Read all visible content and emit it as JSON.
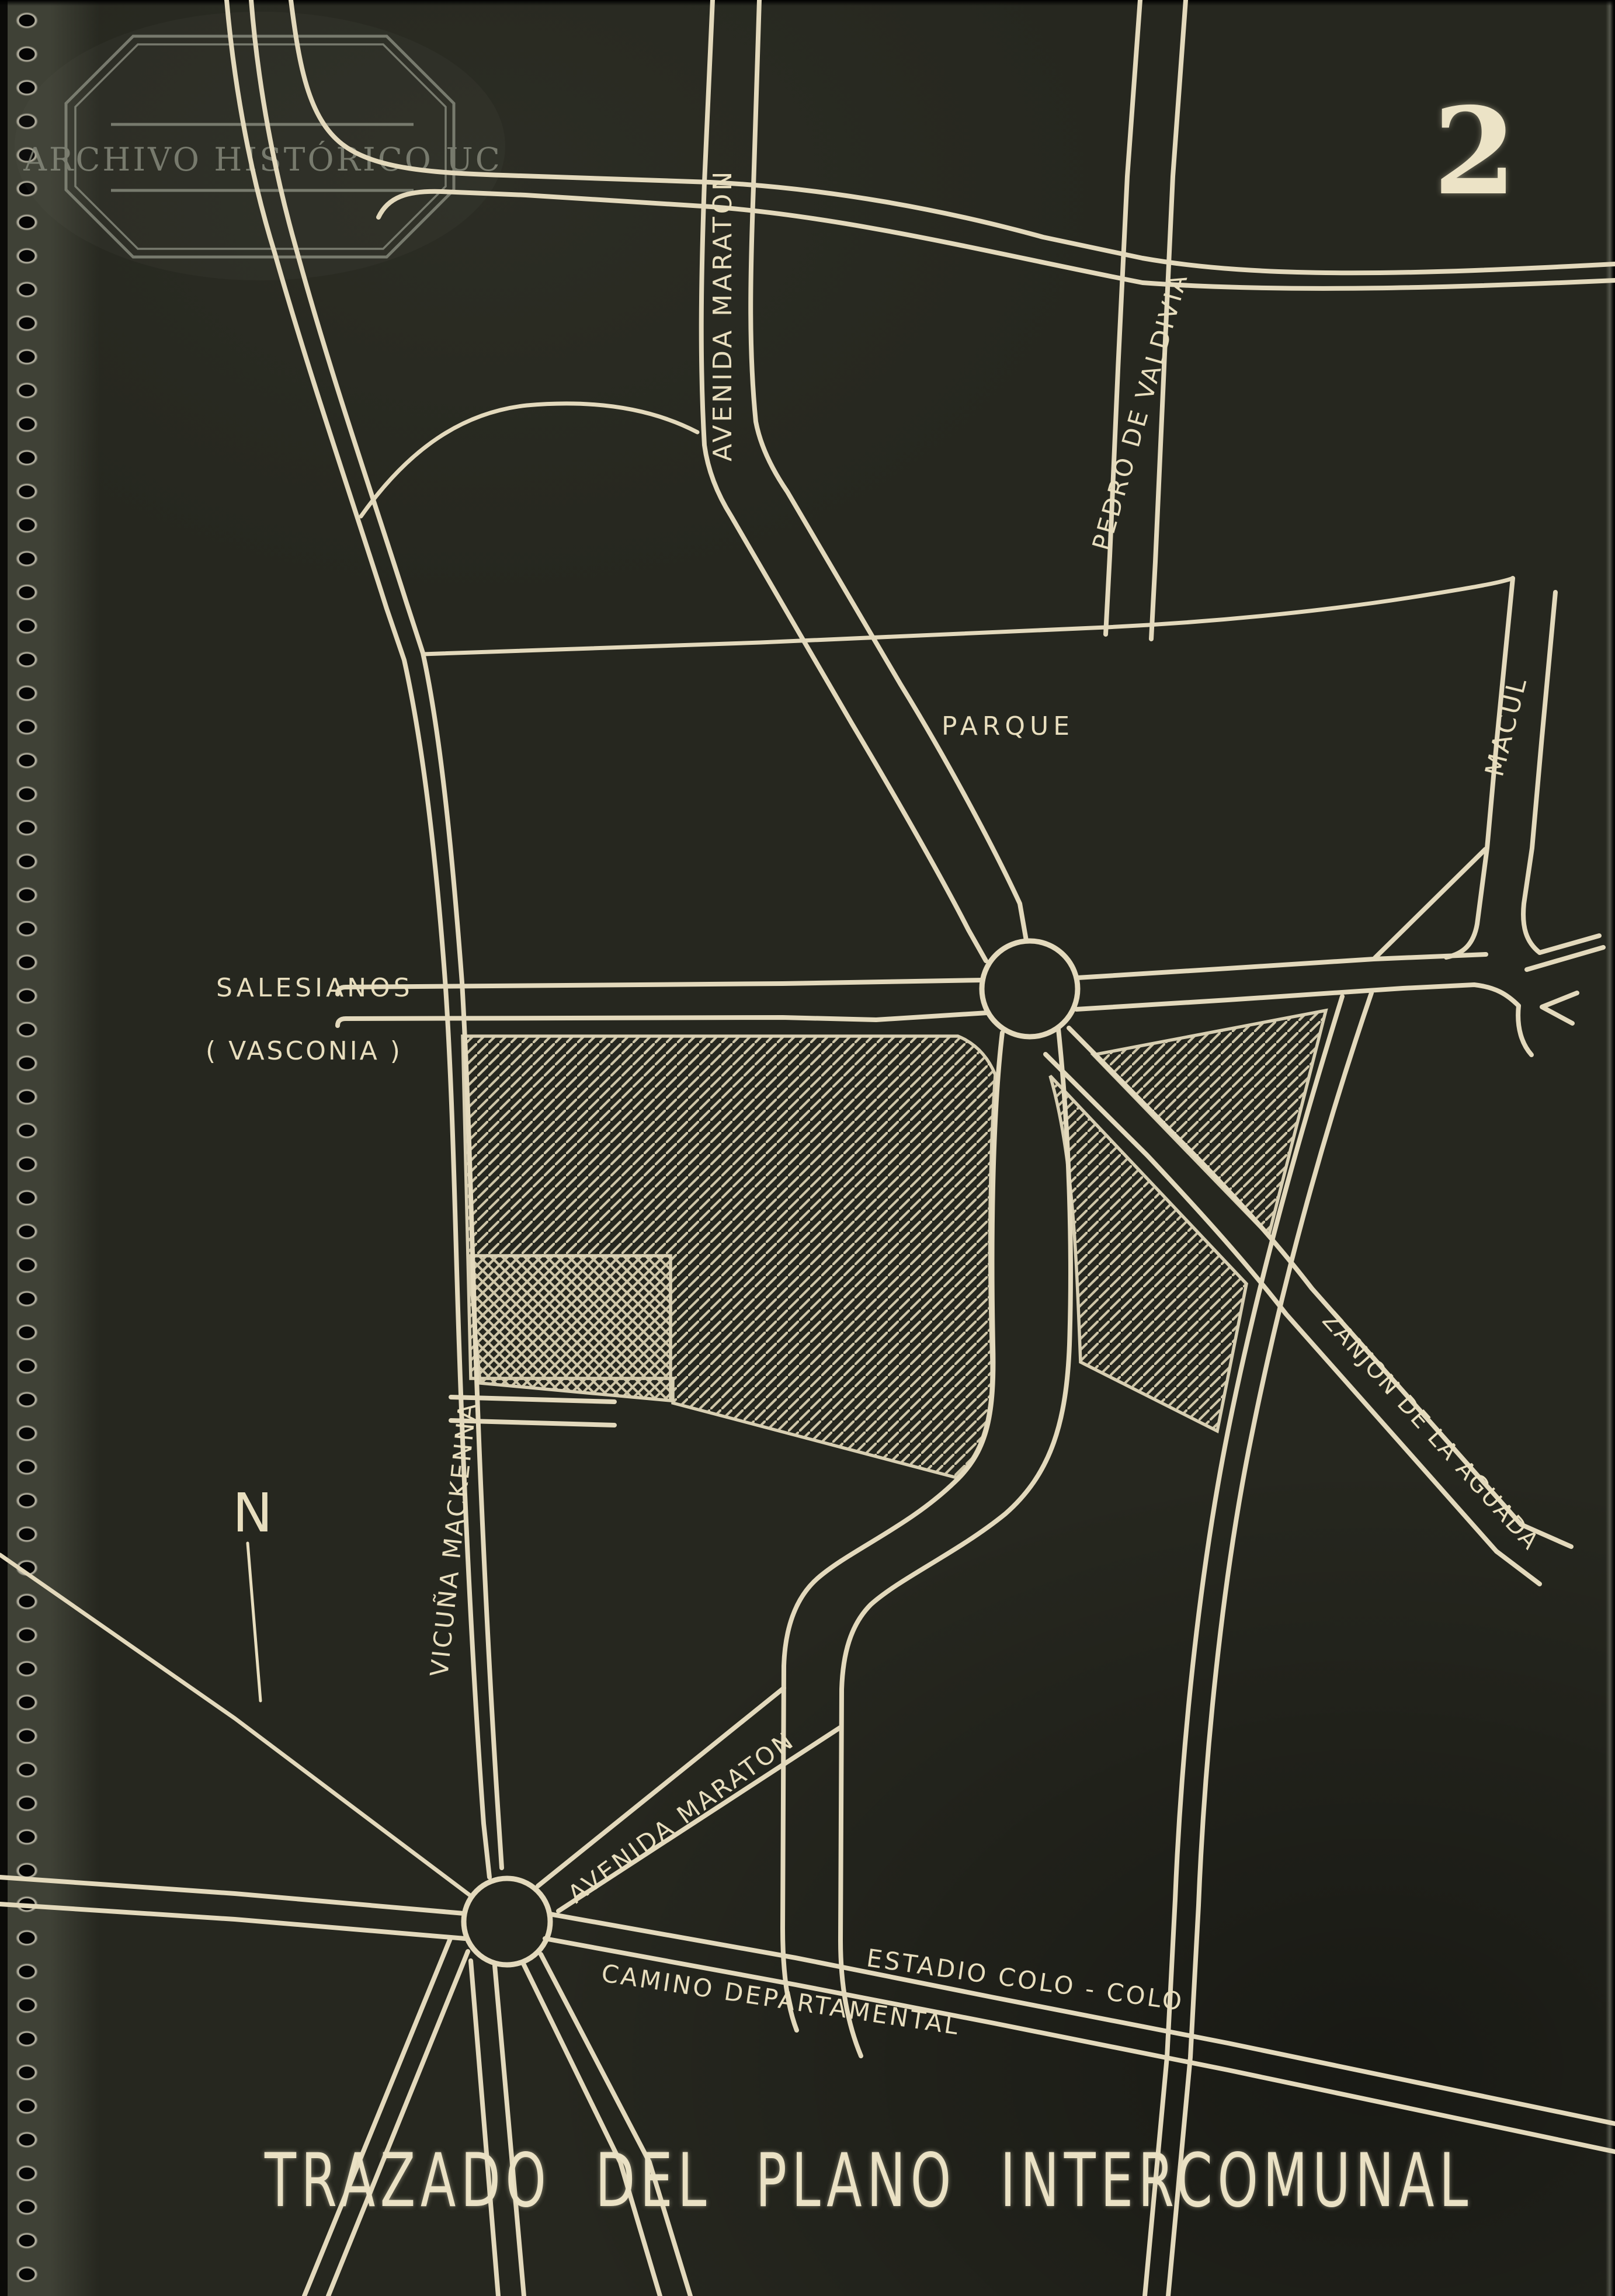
{
  "colors": {
    "bg": "#26271f",
    "paper": "#3f4136",
    "road": "#e3d9bc",
    "hatch": "#cfc6a8",
    "outline": "#d8cfb2",
    "label": "#e8debe",
    "watermark": "#8b8e80",
    "title": "#eae1c4",
    "number": "#ece3c6"
  },
  "page": {
    "number": "2",
    "title": "TRAZADO DEL PLANO INTERCOMUNAL"
  },
  "watermark": {
    "text": "ARCHIVO HISTÓRICO UC"
  },
  "compass": {
    "north": "N"
  },
  "map": {
    "labels": [
      {
        "id": "avenida-maraton-norte",
        "text": "AVENIDA MARATON"
      },
      {
        "id": "pedro-de-valdivia",
        "text": "PEDRO DE VALDIVIA"
      },
      {
        "id": "macul",
        "text": "MACUL"
      },
      {
        "id": "parque",
        "text": "PARQUE"
      },
      {
        "id": "salesianos",
        "text": "SALESIANOS"
      },
      {
        "id": "vasconia",
        "text": "( VASCONIA )"
      },
      {
        "id": "zanjon-de-la-aguada",
        "text": "ZANJON  DE  LA  AGUADA"
      },
      {
        "id": "vicuna-mackenna",
        "text": "VICUÑA MACKENNA"
      },
      {
        "id": "avenida-maraton-sur",
        "text": "AVENIDA  MARATON"
      },
      {
        "id": "estadio-colo-colo",
        "text": "ESTADIO  COLO - COLO"
      },
      {
        "id": "camino-departamental",
        "text": "CAMINO  DEPARTAMENTAL"
      }
    ]
  }
}
